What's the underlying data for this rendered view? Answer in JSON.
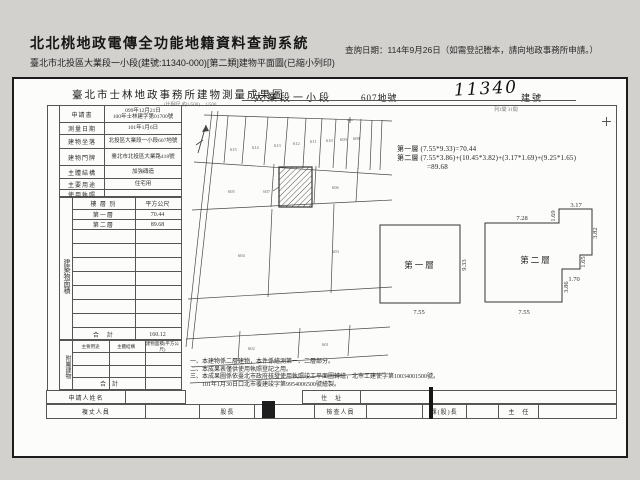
{
  "app": {
    "title": "北北桃地政電傳全功能地籍資料查詢系統",
    "query_date": "查詢日期：114年9月26日（如需登記謄本，請向地政事務所申請。）",
    "subtitle": "臺北市北投區大業段一小段(建號:11340-000)[第二類]建物平面圖(已縮小列印)"
  },
  "form": {
    "title": "臺北市士林地政事務所建物測量成果圖",
    "section": "大業段一小段",
    "lot": "607地號",
    "building_no": "11340",
    "building_no_label": "建號",
    "scale_note": "(比例尺 約1/500)　1/500",
    "scale_note2": "列1間 31間",
    "rows": [
      {
        "label": "申請書",
        "value": "099年12月21日",
        "value2": "100年士林建字第01700號"
      },
      {
        "label": "測量日期",
        "value": "101年1月6日",
        "value2": ""
      },
      {
        "label": "建物坐落",
        "value": "北投區大業段一小段607地號",
        "value2": ""
      },
      {
        "label": "建物門牌",
        "value": "臺北市北投區大業路418號",
        "value2": ""
      },
      {
        "label": "主體結構",
        "value": "加強磚造",
        "value2": ""
      },
      {
        "label": "主要用途",
        "value": "住宅用",
        "value2": ""
      },
      {
        "label": "使用執照",
        "value": "",
        "value2": ""
      }
    ],
    "floor_table": {
      "side_label": "建築物面積",
      "col_floor": "樓 層 別",
      "col_area": "平方公尺",
      "rows": [
        {
          "floor": "第一層",
          "area": "70.44"
        },
        {
          "floor": "第二層",
          "area": "89.68"
        }
      ],
      "total_label": "合　計",
      "total": "160.12"
    },
    "annex": {
      "side_label": "附屬建物",
      "h1": "主要用途",
      "h2": "主體結構",
      "h3": "建物面積(平方公尺)",
      "total_label": "合　計"
    },
    "applicant": {
      "label": "申請人姓名",
      "address_label": "住　址"
    },
    "staff": [
      "複丈人員",
      "股長",
      "檢查人員",
      "課(股)長",
      "主　任"
    ],
    "notes": [
      "一、本建物係二層建物，本件係繪測第一、二層部分。",
      "二、本成果表僅供使用執照登記之用。",
      "三、本成果圖係依臺北市政府核發使用執照竣工平面圖轉繪，北市工建使字第10034001500號。",
      "　　101年1月30日口北市覆建竣字第9954006500號繪製。"
    ],
    "calc": {
      "l1": "第一層 (7.55*9.33)=70.44",
      "l2": "第二層 (7.55*3.86)+(10.45*3.82)+(3.17*1.69)+(9.25*1.65)",
      "l3": "=89.68"
    },
    "plan1": {
      "name": "第一層",
      "w": "7.55",
      "h": "9.33"
    },
    "plan2": {
      "name": "第二層",
      "d728": "7.28",
      "d169": "1.69",
      "d317": "3.17",
      "d382": "3.82",
      "d165": "1.65",
      "d170": "1.70",
      "d386": "3.86",
      "d755": "7.55"
    },
    "map": {
      "subject": "607",
      "parcels": [
        "615",
        "614",
        "613",
        "612",
        "611",
        "610",
        "609",
        "608",
        "605",
        "606",
        "604",
        "603",
        "602",
        "601"
      ]
    }
  }
}
